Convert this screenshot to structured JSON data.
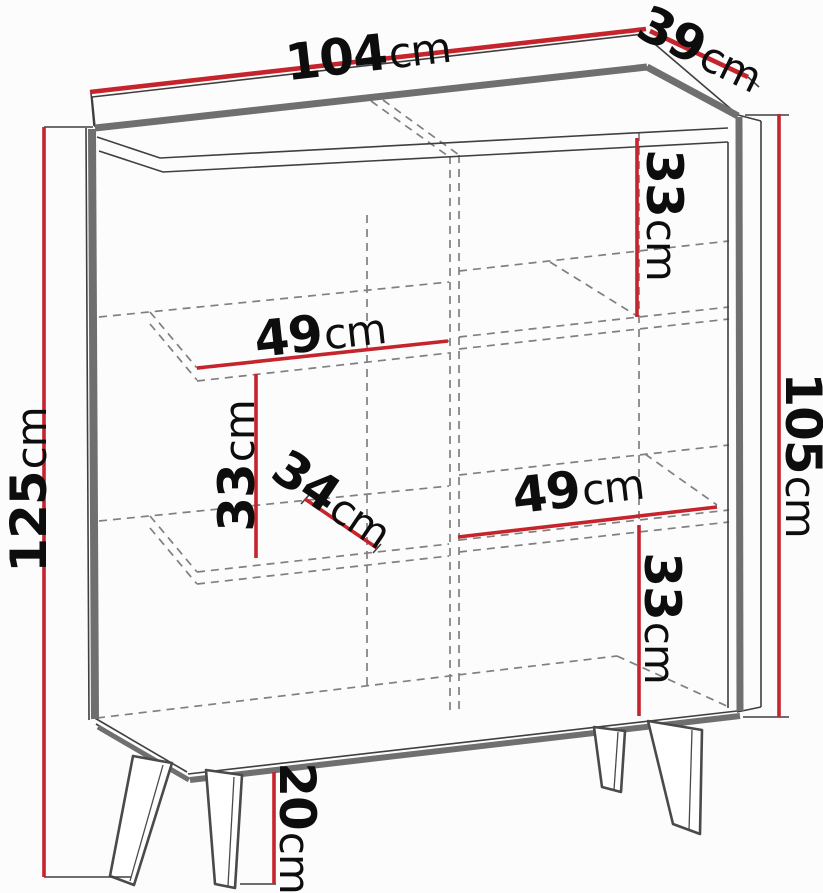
{
  "diagram_type": "furniture-dimension-diagram",
  "subject": "sideboard cabinet with splayed legs, center divider and two shelves per side",
  "unit": "cm",
  "colors": {
    "dimension_red": "#c5242c",
    "outline_dark": "#3f3f3f",
    "edge_gray": "#6f6f6f",
    "dashed_gray": "#808080",
    "background": "#fcfcfc",
    "label_color": "#0d0d0d"
  },
  "dims": {
    "width": {
      "value": "104",
      "unit": "cm"
    },
    "depth": {
      "value": "39",
      "unit": "cm"
    },
    "total_height": {
      "value": "125",
      "unit": "cm"
    },
    "body_height": {
      "value": "105",
      "unit": "cm"
    },
    "top_right_compartment_height": {
      "value": "33",
      "unit": "cm"
    },
    "left_shelf_width": {
      "value": "49",
      "unit": "cm"
    },
    "left_compartment_height": {
      "value": "33",
      "unit": "cm"
    },
    "shelf_depth": {
      "value": "34",
      "unit": "cm"
    },
    "right_shelf_width": {
      "value": "49",
      "unit": "cm"
    },
    "bottom_right_compartment_height": {
      "value": "33",
      "unit": "cm"
    },
    "leg_height": {
      "value": "20",
      "unit": "cm"
    }
  }
}
